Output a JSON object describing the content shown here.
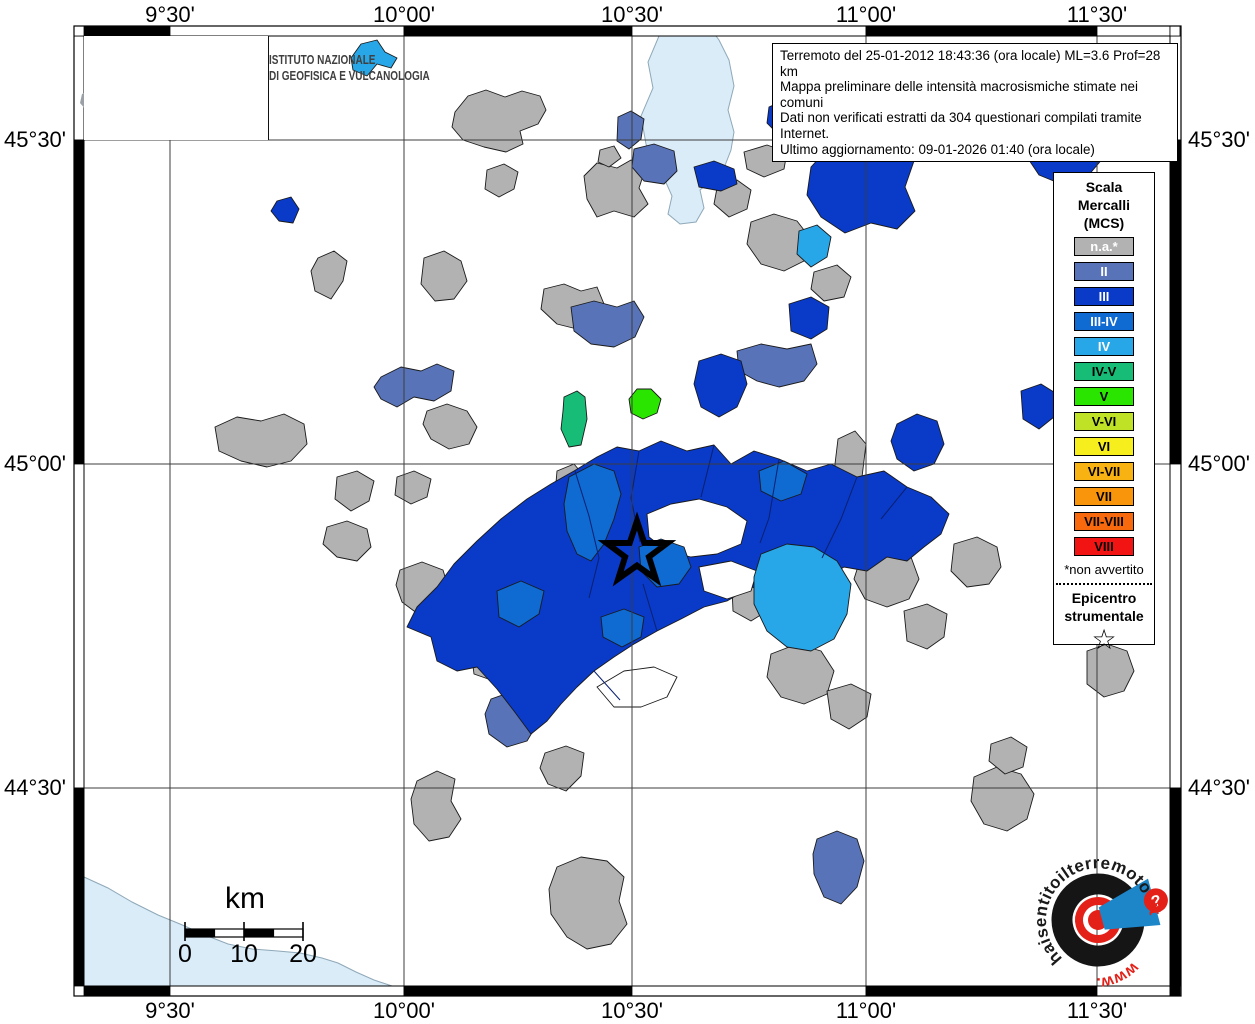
{
  "info_box": {
    "lines": [
      "Terremoto del 25-01-2012 18:43:36 (ora locale) ML=3.6 Prof=28 km",
      "Mappa preliminare delle intensità macrosismiche stimate nei comuni",
      "Dati non verificati estratti da 304 questionari compilati tramite Internet.",
      "Ultimo aggiornamento: 09-01-2026 01:40 (ora locale)"
    ]
  },
  "ingv_logo": {
    "line1": "ISTITUTO NAZIONALE",
    "line2": "DI GEOFISICA E VULCANOLOGIA"
  },
  "axes": {
    "top": [
      "9°30'",
      "10°00'",
      "10°30'",
      "11°00'",
      "11°30'"
    ],
    "bottom": [
      "9°30'",
      "10°00'",
      "10°30'",
      "11°00'",
      "11°30'"
    ],
    "left": [
      "45°30'",
      "45°00'",
      "44°30'"
    ],
    "right": [
      "45°30'",
      "45°00'",
      "44°30'"
    ]
  },
  "legend": {
    "title_lines": [
      "Scala",
      "Mercalli",
      "(MCS)"
    ],
    "items": [
      {
        "label": "n.a.*",
        "color": "#b2b2b2",
        "text": "#ffffff"
      },
      {
        "label": "II",
        "color": "#5873b8",
        "text": "#ffffff"
      },
      {
        "label": "III",
        "color": "#0a3ac8",
        "text": "#ffffff"
      },
      {
        "label": "III-IV",
        "color": "#0f6ad1",
        "text": "#ffffff"
      },
      {
        "label": "IV",
        "color": "#28a7e8",
        "text": "#ffffff"
      },
      {
        "label": "IV-V",
        "color": "#17bd77",
        "text": "#000000"
      },
      {
        "label": "V",
        "color": "#2ae500",
        "text": "#000000"
      },
      {
        "label": "V-VI",
        "color": "#bfe226",
        "text": "#000000"
      },
      {
        "label": "VI",
        "color": "#f7ef1d",
        "text": "#000000"
      },
      {
        "label": "VI-VII",
        "color": "#f8b313",
        "text": "#000000"
      },
      {
        "label": "VII",
        "color": "#f9950a",
        "text": "#000000"
      },
      {
        "label": "VII-VIII",
        "color": "#f8680c",
        "text": "#000000"
      },
      {
        "label": "VIII",
        "color": "#f21313",
        "text": "#000000"
      }
    ],
    "footnote": "*non avvertito",
    "epicenter_label_lines": [
      "Epicentro",
      "strumentale"
    ],
    "epicenter_symbol": "☆"
  },
  "scalebar": {
    "unit": "km",
    "labels": [
      "0",
      "10",
      "20"
    ]
  },
  "watermark": {
    "arc_text": "haisentitoilterremoto",
    "arc_text_accent": ".it",
    "bottom_text": "www.",
    "badge": "?",
    "colors": {
      "black": "#1a1a1a",
      "red": "#e32119",
      "blue": "#1c86c8"
    }
  },
  "map": {
    "background": "#ffffff",
    "water_color": "#d9ecf8",
    "grid_color": "#3c3c3c",
    "palette": {
      "na": "#b2b2b2",
      "II": "#5873b8",
      "III": "#0a3ac8",
      "III4": "#0f6ad1",
      "IV": "#28a7e8",
      "IV5": "#17bd77",
      "V": "#2ae500",
      "white": "#ffffff"
    },
    "grid_x": [
      170,
      404,
      632,
      866,
      1097
    ],
    "grid_y": [
      140,
      464,
      788
    ],
    "epicenter": {
      "x": 637,
      "y": 553
    },
    "water": [
      {
        "name": "sea",
        "pts": "84,877 108,888 132,902 158,915 180,924 205,935 228,944 252,949 278,951 300,953 322,958 338,963 356,972 374,980 392,986 84,986"
      },
      {
        "name": "lake",
        "pts": "659,36 648,62 653,88 641,116 646,144 653,163 664,178 672,196 668,214 680,224 696,222 704,208 700,190 712,180 724,168 731,150 734,132 728,110 734,86 729,60 719,40 716,36"
      }
    ],
    "mass_borders": [
      "575,471 589,516 599,558 589,598",
      "639,451 631,498 640,542",
      "714,445 701,497",
      "779,459 769,518 760,543",
      "857,477 841,519 822,558",
      "907,487 881,519",
      "657,631 643,584",
      "594,671 620,700"
    ],
    "regions": [
      {
        "c": "na",
        "pts": "455,112 468,96 486,90 505,97 522,91 540,96 546,110 538,124 520,131 523,144 506,152 484,147 463,140 452,127"
      },
      {
        "c": "na",
        "pts": "487,170 504,164 518,172 514,189 499,197 485,189"
      },
      {
        "c": "na",
        "pts": "584,176 597,163 617,168 631,160 645,170 639,188 648,204 634,217 614,211 597,217 587,199"
      },
      {
        "c": "na",
        "pts": "600,150 614,146 621,158 609,167 598,162"
      },
      {
        "c": "na",
        "pts": "717,188 737,180 751,190 747,209 729,217 714,204"
      },
      {
        "c": "na",
        "pts": "744,152 767,145 787,152 784,169 764,177 747,169"
      },
      {
        "c": "na",
        "pts": "751,222 774,214 797,221 811,239 804,261 784,271 761,264 747,244"
      },
      {
        "c": "na",
        "pts": "814,272 837,265 851,277 844,297 824,301 811,289"
      },
      {
        "c": "na",
        "pts": "318,258 334,251 347,261 343,281 331,299 315,291 311,271"
      },
      {
        "c": "na",
        "pts": "424,258 444,251 461,261 467,281 454,299 435,301 421,284"
      },
      {
        "c": "na",
        "pts": "544,289 564,284 581,291 597,287 604,304 594,321 577,329 557,324 541,309"
      },
      {
        "c": "na",
        "pts": "427,411 447,404 467,411 477,427 469,444 449,449 431,439 423,424"
      },
      {
        "c": "na",
        "pts": "215,427 237,417 261,421 284,414 304,424 307,444 291,461 267,467 241,461 219,451"
      },
      {
        "c": "na",
        "pts": "337,477 357,471 374,481 369,501 351,511 335,499"
      },
      {
        "c": "na",
        "pts": "327,527 347,521 367,529 371,547 357,561 337,557 323,544"
      },
      {
        "c": "na",
        "pts": "397,477 414,471 431,479 427,497 411,504 395,495"
      },
      {
        "c": "na",
        "pts": "557,471 574,464 585,477 582,499 567,507 555,494"
      },
      {
        "c": "na",
        "pts": "400,570 422,562 443,570 449,590 438,608 418,614 402,602 396,585"
      },
      {
        "c": "na",
        "pts": "450,596 476,588 500,596 512,618 526,640 518,664 498,676 476,668 458,648 446,622"
      },
      {
        "c": "na",
        "pts": "471,651 494,644 514,651 511,671 494,681 474,674"
      },
      {
        "c": "na",
        "pts": "545,753 566,746 584,753 581,776 566,791 548,784 540,768"
      },
      {
        "c": "na",
        "pts": "417,781 437,771 455,779 451,801 461,819 449,837 429,841 414,824 411,799"
      },
      {
        "c": "na",
        "pts": "557,867 581,857 607,861 624,877 619,901 627,924 611,944 587,949 567,937 551,914 549,889"
      },
      {
        "c": "na",
        "pts": "732,587 754,579 771,589 767,611 751,621 733,611"
      },
      {
        "c": "na",
        "pts": "771,654 797,644 821,651 834,671 827,694 804,704 781,697 767,677"
      },
      {
        "c": "na",
        "pts": "827,691 851,684 871,694 867,717 849,729 831,719"
      },
      {
        "c": "na",
        "pts": "838,439 855,431 866,444 862,477 857,507 844,511 834,491 835,464"
      },
      {
        "c": "na",
        "pts": "787,527 801,521 811,531 807,551 794,557 784,544"
      },
      {
        "c": "na",
        "pts": "861,557 887,549 911,557 919,579 909,599 887,607 865,599 854,579"
      },
      {
        "c": "na",
        "pts": "904,611 927,604 947,614 944,637 927,649 907,641"
      },
      {
        "c": "na",
        "pts": "954,544 977,537 997,547 1001,567 989,584 967,587 951,571"
      },
      {
        "c": "na",
        "pts": "974,777 997,767 1021,774 1034,794 1027,819 1007,831 984,824 971,801"
      },
      {
        "c": "na",
        "pts": "991,744 1011,737 1027,747 1023,767 1005,774 989,761"
      },
      {
        "c": "na",
        "pts": "1087,651 1107,644 1127,651 1134,671 1124,691 1104,697 1087,684"
      },
      {
        "c": "II",
        "pts": "618,117 631,111 644,119 641,139 629,149 617,141"
      },
      {
        "c": "II",
        "pts": "634,149 654,144 674,151 677,171 664,184 644,181 632,167"
      },
      {
        "c": "II",
        "pts": "571,307 594,301 617,307 634,301 644,317 635,337 614,347 591,344 574,331"
      },
      {
        "c": "II",
        "pts": "381,377 401,367 421,371 437,364 454,371 451,391 434,401 414,397 397,407 381,399 374,387"
      },
      {
        "c": "II",
        "pts": "737,351 761,344 787,349 811,344 817,364 804,381 779,387 757,381 739,371"
      },
      {
        "c": "II",
        "pts": "491,699 514,691 534,699 539,721 527,741 507,747 489,734 485,714"
      },
      {
        "c": "II",
        "pts": "817,839 837,831 857,839 864,861 857,887 841,904 824,897 814,874 813,854"
      },
      {
        "c": "III",
        "pts": "277,201 291,197 299,209 293,223 279,221 271,211"
      },
      {
        "c": "III",
        "pts": "694,167 714,161 734,169 737,184 721,191 699,187"
      },
      {
        "c": "III",
        "pts": "769,107 787,99 801,111 797,129 779,135 767,123"
      },
      {
        "c": "III",
        "pts": "811,167 831,145 854,137 877,145 901,139 914,161 905,187 915,211 897,229 871,223 845,233 821,217 807,195"
      },
      {
        "c": "III",
        "pts": "1027,157 1041,131 1061,119 1084,117 1101,131 1104,157 1087,177 1061,184 1039,175"
      },
      {
        "c": "III",
        "pts": "789,304 811,297 829,307 827,329 811,339 791,331"
      },
      {
        "c": "III",
        "pts": "699,361 721,354 741,361 747,384 737,407 719,417 701,407 694,384"
      },
      {
        "c": "III",
        "pts": "897,424 917,414 937,421 944,444 934,464 914,471 897,459 891,441"
      },
      {
        "c": "III",
        "pts": "1021,391 1041,384 1057,394 1054,417 1039,429 1023,419"
      },
      {
        "c": "III",
        "pts": "431,637 407,627 417,607 437,587 454,564 477,541 501,519 527,499 551,484 574,471 597,457 617,447 639,451 661,441 687,451 714,445 731,464 754,451 779,459 807,471 831,464 857,477 884,471 907,487 931,497 949,514 941,534 924,547 907,561 887,557 867,571 844,567 821,581 797,577 774,591 751,587 727,601 704,607 681,619 657,631 634,644 614,657 594,671 577,687 561,704 547,721 531,734 514,711 497,689 477,667 457,671 437,661"
      },
      {
        "c": "white",
        "pts": "647,514 671,504 699,499 727,507 747,521 741,544 717,554 691,557 667,551 649,537"
      },
      {
        "c": "white",
        "pts": "699,567 731,561 757,571 751,591 727,599 704,591"
      },
      {
        "c": "white",
        "pts": "597,687 624,671 654,667 677,677 667,697 641,707 614,707"
      },
      {
        "c": "white",
        "pts": "584,511 601,504 611,517 604,534 589,531"
      },
      {
        "c": "III4",
        "pts": "569,477 594,464 614,471 621,494 614,519 604,544 591,561 577,554 567,531 564,504"
      },
      {
        "c": "III4",
        "pts": "639,547 661,539 684,547 691,567 679,584 657,587 641,571"
      },
      {
        "c": "III4",
        "pts": "759,471 784,461 807,474 801,494 781,501 761,491"
      },
      {
        "c": "III4",
        "pts": "497,591 521,581 544,591 539,614 519,627 499,617"
      },
      {
        "c": "III4",
        "pts": "601,617 624,609 644,617 641,637 622,647 603,637"
      },
      {
        "c": "IV",
        "pts": "351,58 361,44 377,40 385,52 397,58 391,68 377,64 367,76 353,70"
      },
      {
        "c": "IV",
        "pts": "857,108 871,100 891,97 907,107 901,121 884,129 864,124"
      },
      {
        "c": "IV",
        "pts": "799,231 817,225 831,237 827,257 811,267 797,254"
      },
      {
        "c": "IV",
        "pts": "761,554 787,544 814,547 837,561 851,584 847,614 834,639 811,651 787,647 767,631 754,604 754,577"
      },
      {
        "c": "IV5",
        "pts": "564,397 577,391 585,397 587,419 581,445 569,447 561,429 563,411"
      },
      {
        "c": "V",
        "pts": "629,399 637,389 651,389 661,399 657,413 643,419 631,413"
      }
    ]
  }
}
